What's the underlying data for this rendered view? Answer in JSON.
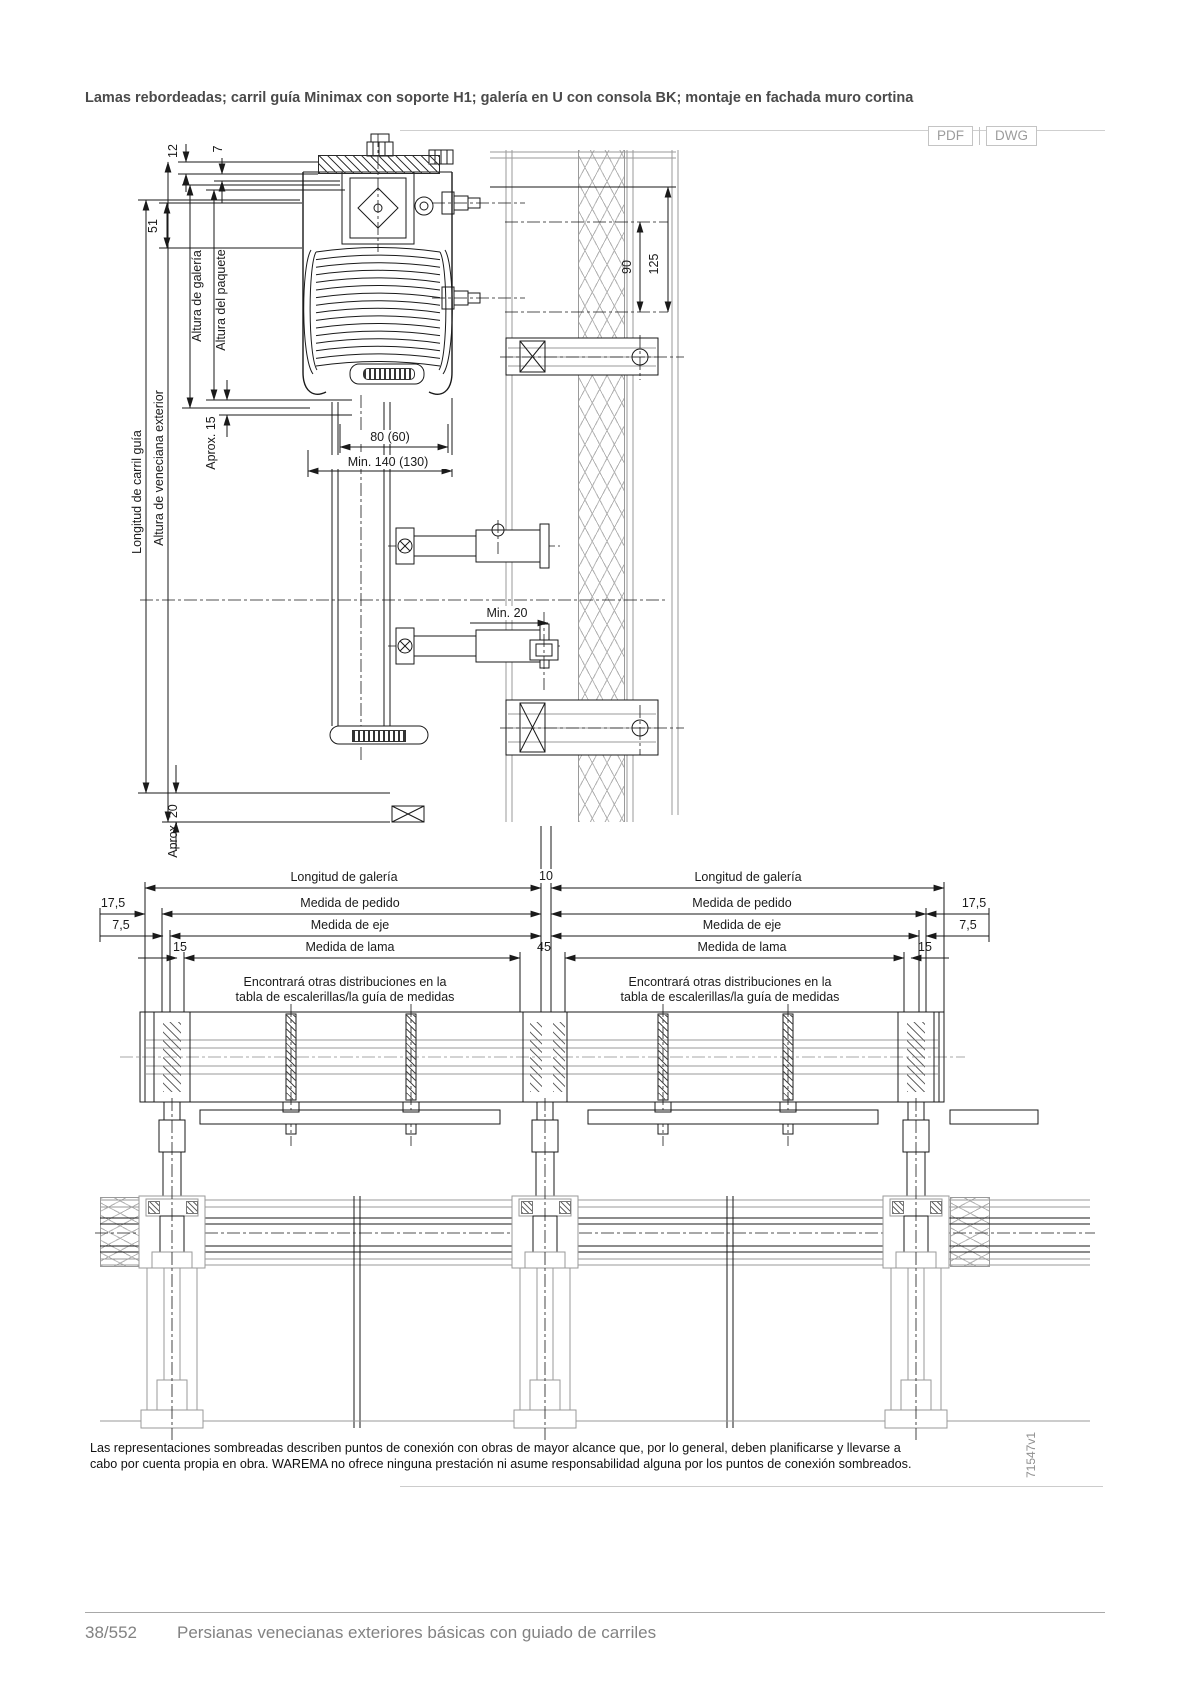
{
  "header": {
    "title": "Lamas rebordeadas; carril guía Minimax con soporte H1; galería en U con consola BK; montaje en fachada muro cortina",
    "pdf": "PDF",
    "dwg": "DWG"
  },
  "section_view": {
    "d12": "12",
    "d7": "7",
    "d51": "51",
    "altura_galeria": "Altura de galería",
    "altura_paquete": "Altura del paquete",
    "altura_veneciana": "Altura de veneciana exterior",
    "longitud_carril": "Longitud de carril guía",
    "aprox15": "Aprox. 15",
    "d80": "80 (60)",
    "min140": "Min. 140 (130)",
    "min20": "Min. 20",
    "aprox20": "Aprox. 20",
    "d90": "90",
    "d125": "125"
  },
  "plan_view": {
    "longitud_galeria": "Longitud de galería",
    "d10": "10",
    "medida_pedido": "Medida de pedido",
    "d17_5": "17,5",
    "medida_eje": "Medida de eje",
    "d7_5": "7,5",
    "medida_lama": "Medida de lama",
    "d15": "15",
    "d45": "45",
    "note_line1": "Encontrará otras distribuciones en la",
    "note_line2": "tabla de escalerillas/la guía de medidas"
  },
  "footnote": {
    "line1": "Las representaciones sombreadas describen puntos de conexión con obras de mayor alcance que, por lo general, deben planificarse y llevarse a",
    "line2": "cabo por cuenta propia en obra. WAREMA no ofrece ninguna prestación ni asume responsabilidad alguna por los puntos de conexión sombreados.",
    "drawing_id": "71547v1"
  },
  "footer": {
    "page": "38/552",
    "chapter": "Persianas venecianas exteriores básicas con guiado de carriles"
  },
  "colors": {
    "line": "#1a1a1a",
    "secondary_line": "#9a9a9a",
    "title_text": "#4a4a4a",
    "footer_text": "#828282",
    "button_border": "#c4c4c4",
    "button_text": "#9c9c9c"
  }
}
